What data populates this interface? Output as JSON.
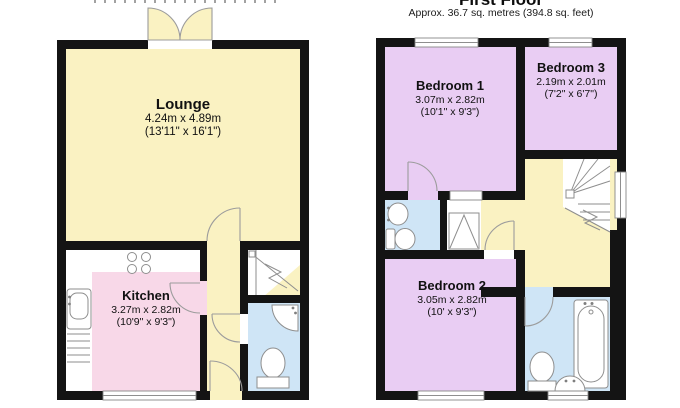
{
  "first_floor": {
    "title": "First Floor",
    "subtitle": "Approx. 36.7 sq. metres (394.8 sq. feet)",
    "rooms": {
      "bedroom1": {
        "name": "Bedroom 1",
        "metric": "3.07m x 2.82m",
        "imperial": "(10'1\" x 9'3\")"
      },
      "bedroom3": {
        "name": "Bedroom 3",
        "metric": "2.19m x 2.01m",
        "imperial": "(7'2\" x 6'7\")"
      },
      "bedroom2": {
        "name": "Bedroom 2",
        "metric": "3.05m x 2.82m",
        "imperial": "(10' x 9'3\")"
      }
    }
  },
  "ground_floor": {
    "rooms": {
      "lounge": {
        "name": "Lounge",
        "metric": "4.24m x 4.89m",
        "imperial": "(13'11\" x 16'1\")"
      },
      "kitchen": {
        "name": "Kitchen",
        "metric": "3.27m x 2.82m",
        "imperial": "(10'9\" x 9'3\")"
      }
    }
  },
  "colors": {
    "wall": "#141414",
    "room_yellow": "#faf2c2",
    "room_pink": "#f8d8e8",
    "room_lilac": "#e9cdf3",
    "room_blue": "#cfe5f6",
    "fixture_stroke": "#8e8e8e",
    "background": "#ffffff"
  }
}
